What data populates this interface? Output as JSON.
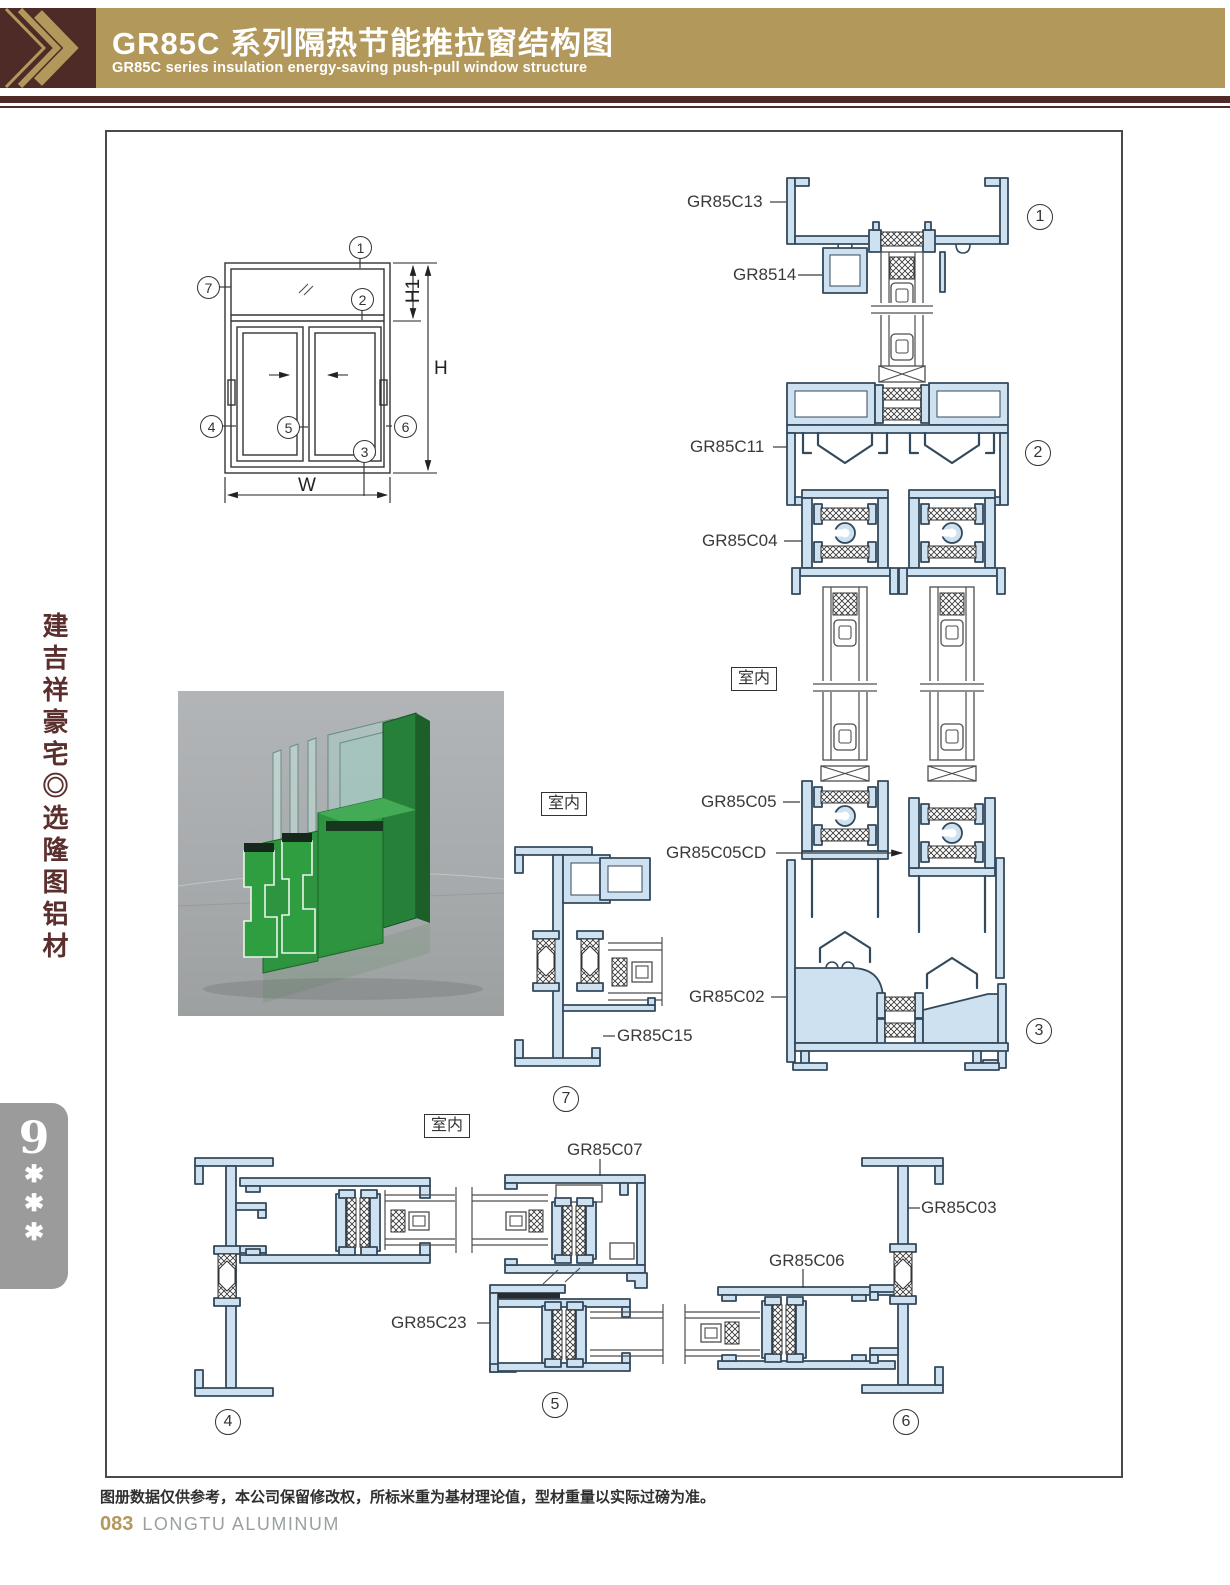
{
  "header": {
    "title": "GR85C 系列隔热节能推拉窗结构图",
    "subtitle": "GR85C series insulation energy-saving push-pull window structure",
    "gold": "#b3985c",
    "maroon": "#4f2b28"
  },
  "sidebar": {
    "slogan": "建吉祥豪宅◎选隆图铝材",
    "badge": {
      "number": "9",
      "stars": [
        "✱",
        "✱",
        "✱"
      ]
    }
  },
  "schematic": {
    "dims": {
      "h1": "H1",
      "h": "H",
      "w": "W"
    }
  },
  "labels": {
    "interior": "室内",
    "gr85c13": "GR85C13",
    "gr8514": "GR8514",
    "gr85c11": "GR85C11",
    "gr85c04": "GR85C04",
    "gr85c05": "GR85C05",
    "gr85c05cd": "GR85C05CD",
    "gr85c02": "GR85C02",
    "gr85c15": "GR85C15",
    "gr85c07": "GR85C07",
    "gr85c23": "GR85C23",
    "gr85c06": "GR85C06",
    "gr85c03": "GR85C03"
  },
  "markers": {
    "n1": "1",
    "n2": "2",
    "n3": "3",
    "n4": "4",
    "n5": "5",
    "n6": "6",
    "n7": "7"
  },
  "footer": {
    "disclaimer": "图册数据仅供参考，本公司保留修改权，所标米重为基材理论值，型材重量以实际过磅为准。",
    "page_number": "083",
    "brand": "LONGTU ALUMINUM"
  }
}
